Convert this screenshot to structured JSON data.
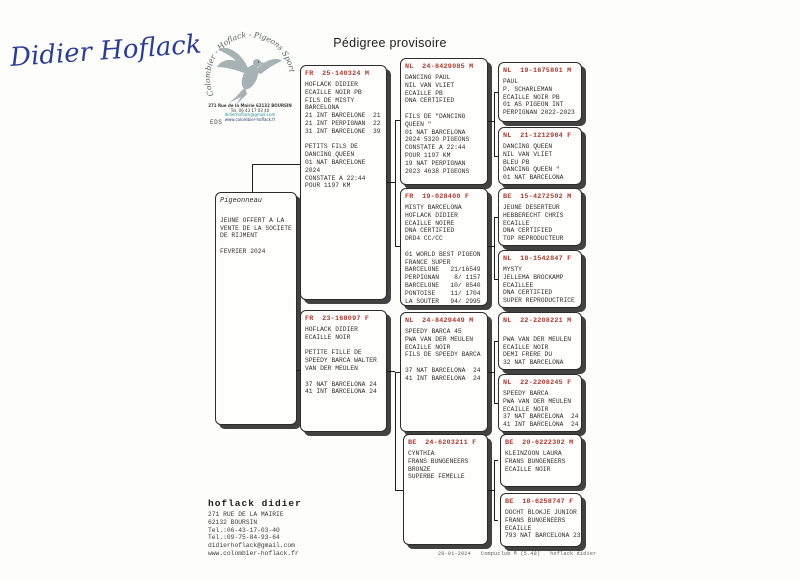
{
  "page": {
    "title": "Pédigree provisoire",
    "signature": "Didier Hoflack",
    "eds_label": "EDS",
    "footer": "28-01-2024   Compuclub ® (5.48)   hoflack didier"
  },
  "colors": {
    "ring_red": "#a93c32",
    "signature_blue": "#2c3e93",
    "logo_teal": "#2e8f8f"
  },
  "logo": {
    "arc_text": "Colombier - Hoflack - Pigeons Sport",
    "lines": [
      "271 Rue de la Mairie 62132 BOURSIN",
      "Tel. 06 43 17 03 40",
      "didierhoflack@gmail.com",
      "www.colombier-hoflack.fr"
    ]
  },
  "owner_block": {
    "name": "hoflack didier",
    "lines": [
      "271 RUE DE LA MAIRIE",
      "62132 BOURSIN",
      "Tel.:06-43-17-03-40",
      "Tel.:09-75-84-93-64",
      "didierhoflack@gmail.com",
      "www.colombier-hoflack.fr"
    ]
  },
  "tree": {
    "subject": {
      "title": "Pigeonneau",
      "lines": [
        "",
        "JEUNE OFFERT A LA",
        "VENTE DE LA SOCIETE",
        "DE RIJMENT",
        "",
        "FEVRIER 2024"
      ]
    },
    "father": {
      "ring": "FR  25-140324 M",
      "lines": [
        "HOFLACK DIDIER",
        "ECAILLE NOIR PB",
        "FILS DE MISTY",
        "BARCELONA",
        "21 INT BARCELONE  21",
        "21 INT PERPIGNAN  22",
        "31 INT BARCELONE  39",
        "",
        "PETITS FILS DE",
        "DANCING QUEEN",
        "01 NAT BARCELONE",
        "2024",
        "CONSTATE A 22:44",
        "POUR 1197 KM"
      ]
    },
    "mother": {
      "ring": "FR  23-168097 F",
      "lines": [
        "HOFLACK DIDIER",
        "ECAILLE NOIR",
        "",
        "PETITE FILLE DE",
        "SPEEDY BARCA WALTER",
        "VAN DER MEULEN",
        "",
        "37 NAT BARCELONA 24",
        "41 INT BARCELONA 24"
      ]
    },
    "ff": {
      "ring": "NL  24-8429085 M",
      "lines": [
        "DANCING PAUL",
        "NIL VAN VLIET",
        "ECAILLE PB",
        "DNA CERTIFIED",
        "",
        "FILS DE \"DANCING",
        "QUEEN \"",
        "01 NAT BARCELONA",
        "2024 5320 PIGEONS",
        "CONSTATE A 22:44",
        "POUR 1197 KM",
        "19 NAT PERPIGNAN",
        "2023 4638 PIGEONS"
      ]
    },
    "fm": {
      "ring": "FR  19-028400 F",
      "lines": [
        "MISTY BARCELONA",
        "HOFLACK DIDIER",
        "ECAILLE NOIRE",
        "DNA CERTIFIED",
        "DRD4 CC/CC",
        "",
        "01 WORLD BEST PIGEON",
        "FRANCE SUPER",
        "BARCELONE   21/16549",
        "PERPIGNAN    8/ 1157",
        "BARCELONE   10/ 8540",
        "PONTOISE    11/ 1704",
        "LA SOUTER   94/ 2995"
      ]
    },
    "mf": {
      "ring": "NL  24-8429449 M",
      "lines": [
        "SPEEDY BARCA 45",
        "PWA VAN DER MEULEN",
        "ECAILLE NOIR",
        "FILS DE SPEEDY BARCA",
        "",
        "37 NAT BARCELONA  24",
        "41 INT BARCELONA  24"
      ]
    },
    "mm": {
      "ring": "BE  24-6203211 F",
      "lines": [
        "CYNTHIA",
        "FRANS BUNGENEERS",
        "BRONZE",
        "SUPERBE FEMELLE"
      ]
    },
    "fff": {
      "ring": "NL  19-1675801 M",
      "lines": [
        "PAUL",
        "P. SCHARLEMAN",
        "ECAILLE NOIR PB",
        "01 AS PIGEON INT",
        "PERPIGNAN 2022-2023"
      ]
    },
    "ffm": {
      "ring": "NL  21-1212984 F",
      "lines": [
        "DANCING QUEEN",
        "NIL VAN VLIET",
        "BLEU PB",
        "DANCING QUEEN \"",
        "01 NAT BARCELONA"
      ]
    },
    "fmf": {
      "ring": "BE  15-4272502 M",
      "lines": [
        "JEUNE DESERTEUR",
        "HEBBERECHT CHRIS",
        "ECAILLE",
        "DNA CERTIFIED",
        "TOP REPRODUCTEUR"
      ]
    },
    "fmm": {
      "ring": "NL  18-1542847 F",
      "lines": [
        "MYSTY",
        "JELLEMA BROCKAMP",
        "ECAILLEE",
        "DNA CERTIFIED",
        "SUPER REPRODUCTRICE"
      ]
    },
    "mff": {
      "ring": "NL  22-2208221 M",
      "lines": [
        "",
        "PWA VAN DER MEULEN",
        "ECAILLE NOIR",
        "DEMI FRERE DU",
        "32 NAT BARCELONA"
      ]
    },
    "mfm": {
      "ring": "NL  22-2208245 F",
      "lines": [
        "SPEEDY BARCA",
        "PWA VAN DER MEULEN",
        "ECAILLE NOIR",
        "37 NAT BARCELONA  24",
        "41 INT BARCELONA  24"
      ]
    },
    "mmf": {
      "ring": "BE  20-6222302 M",
      "lines": [
        "KLEINZOON LAURA",
        "FRANS BUNGENEERS",
        "ECAILLE NOIR"
      ]
    },
    "mmm": {
      "ring": "BE  18-6258747 F",
      "lines": [
        "DOCHT BLOKJE JUNIOR",
        "FRANS BUNGENEERS",
        "ECAILLE",
        "793 NAT BARCELONA 23"
      ]
    }
  }
}
